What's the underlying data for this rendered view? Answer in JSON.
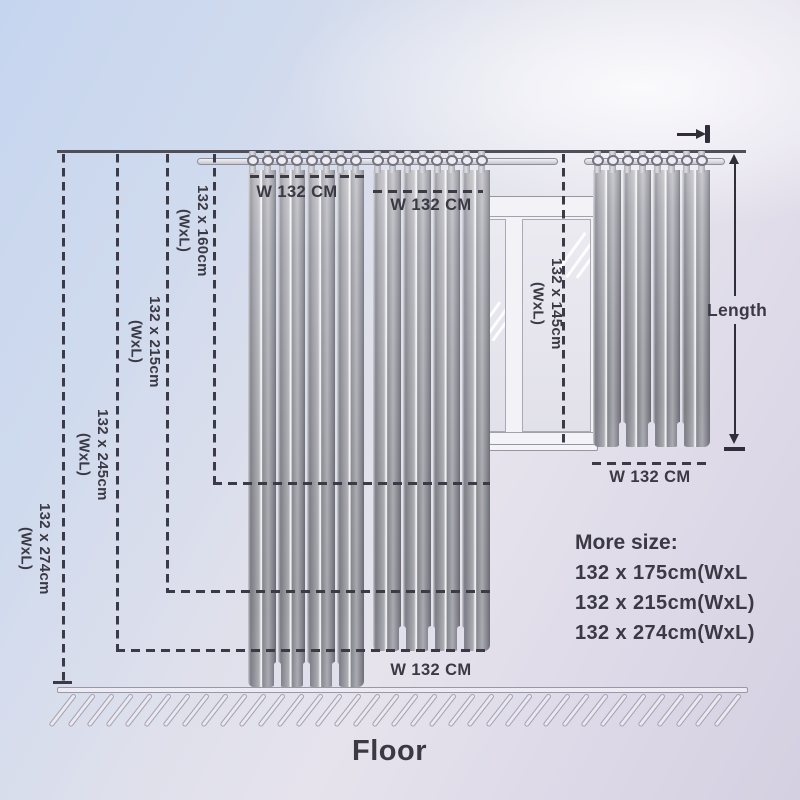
{
  "diagram": {
    "left_sizes": [
      {
        "size": "132 x 160cm",
        "unit": "(WxL)"
      },
      {
        "size": "132 x 215cm",
        "unit": "(WxL)"
      },
      {
        "size": "132 x 245cm",
        "unit": "(WxL)"
      },
      {
        "size": "132 x 274cm",
        "unit": "(WxL)"
      }
    ],
    "window_size": {
      "size": "132 x 145cm",
      "unit": "(WxL)"
    },
    "width_labels": {
      "top_left": "W 132 CM",
      "top_middle": "W 132 CM",
      "right": "W 132 CM",
      "bottom": "W 132 CM"
    },
    "length_label": "Length",
    "floor_label": "Floor",
    "more_size": {
      "title": "More size:",
      "options": [
        "132 x 175cm(WxL",
        "132 x 215cm(WxL)",
        "132 x 274cm(WxL)"
      ]
    },
    "colors": {
      "text": "#3b3944",
      "dash_line": "#3c3a46",
      "curtain_gray": "#97979f",
      "background_top_left": "#c6d5ef",
      "background_bottom": "#d4d0e1",
      "floor_hatch_outline": "#a4a1b0"
    }
  }
}
